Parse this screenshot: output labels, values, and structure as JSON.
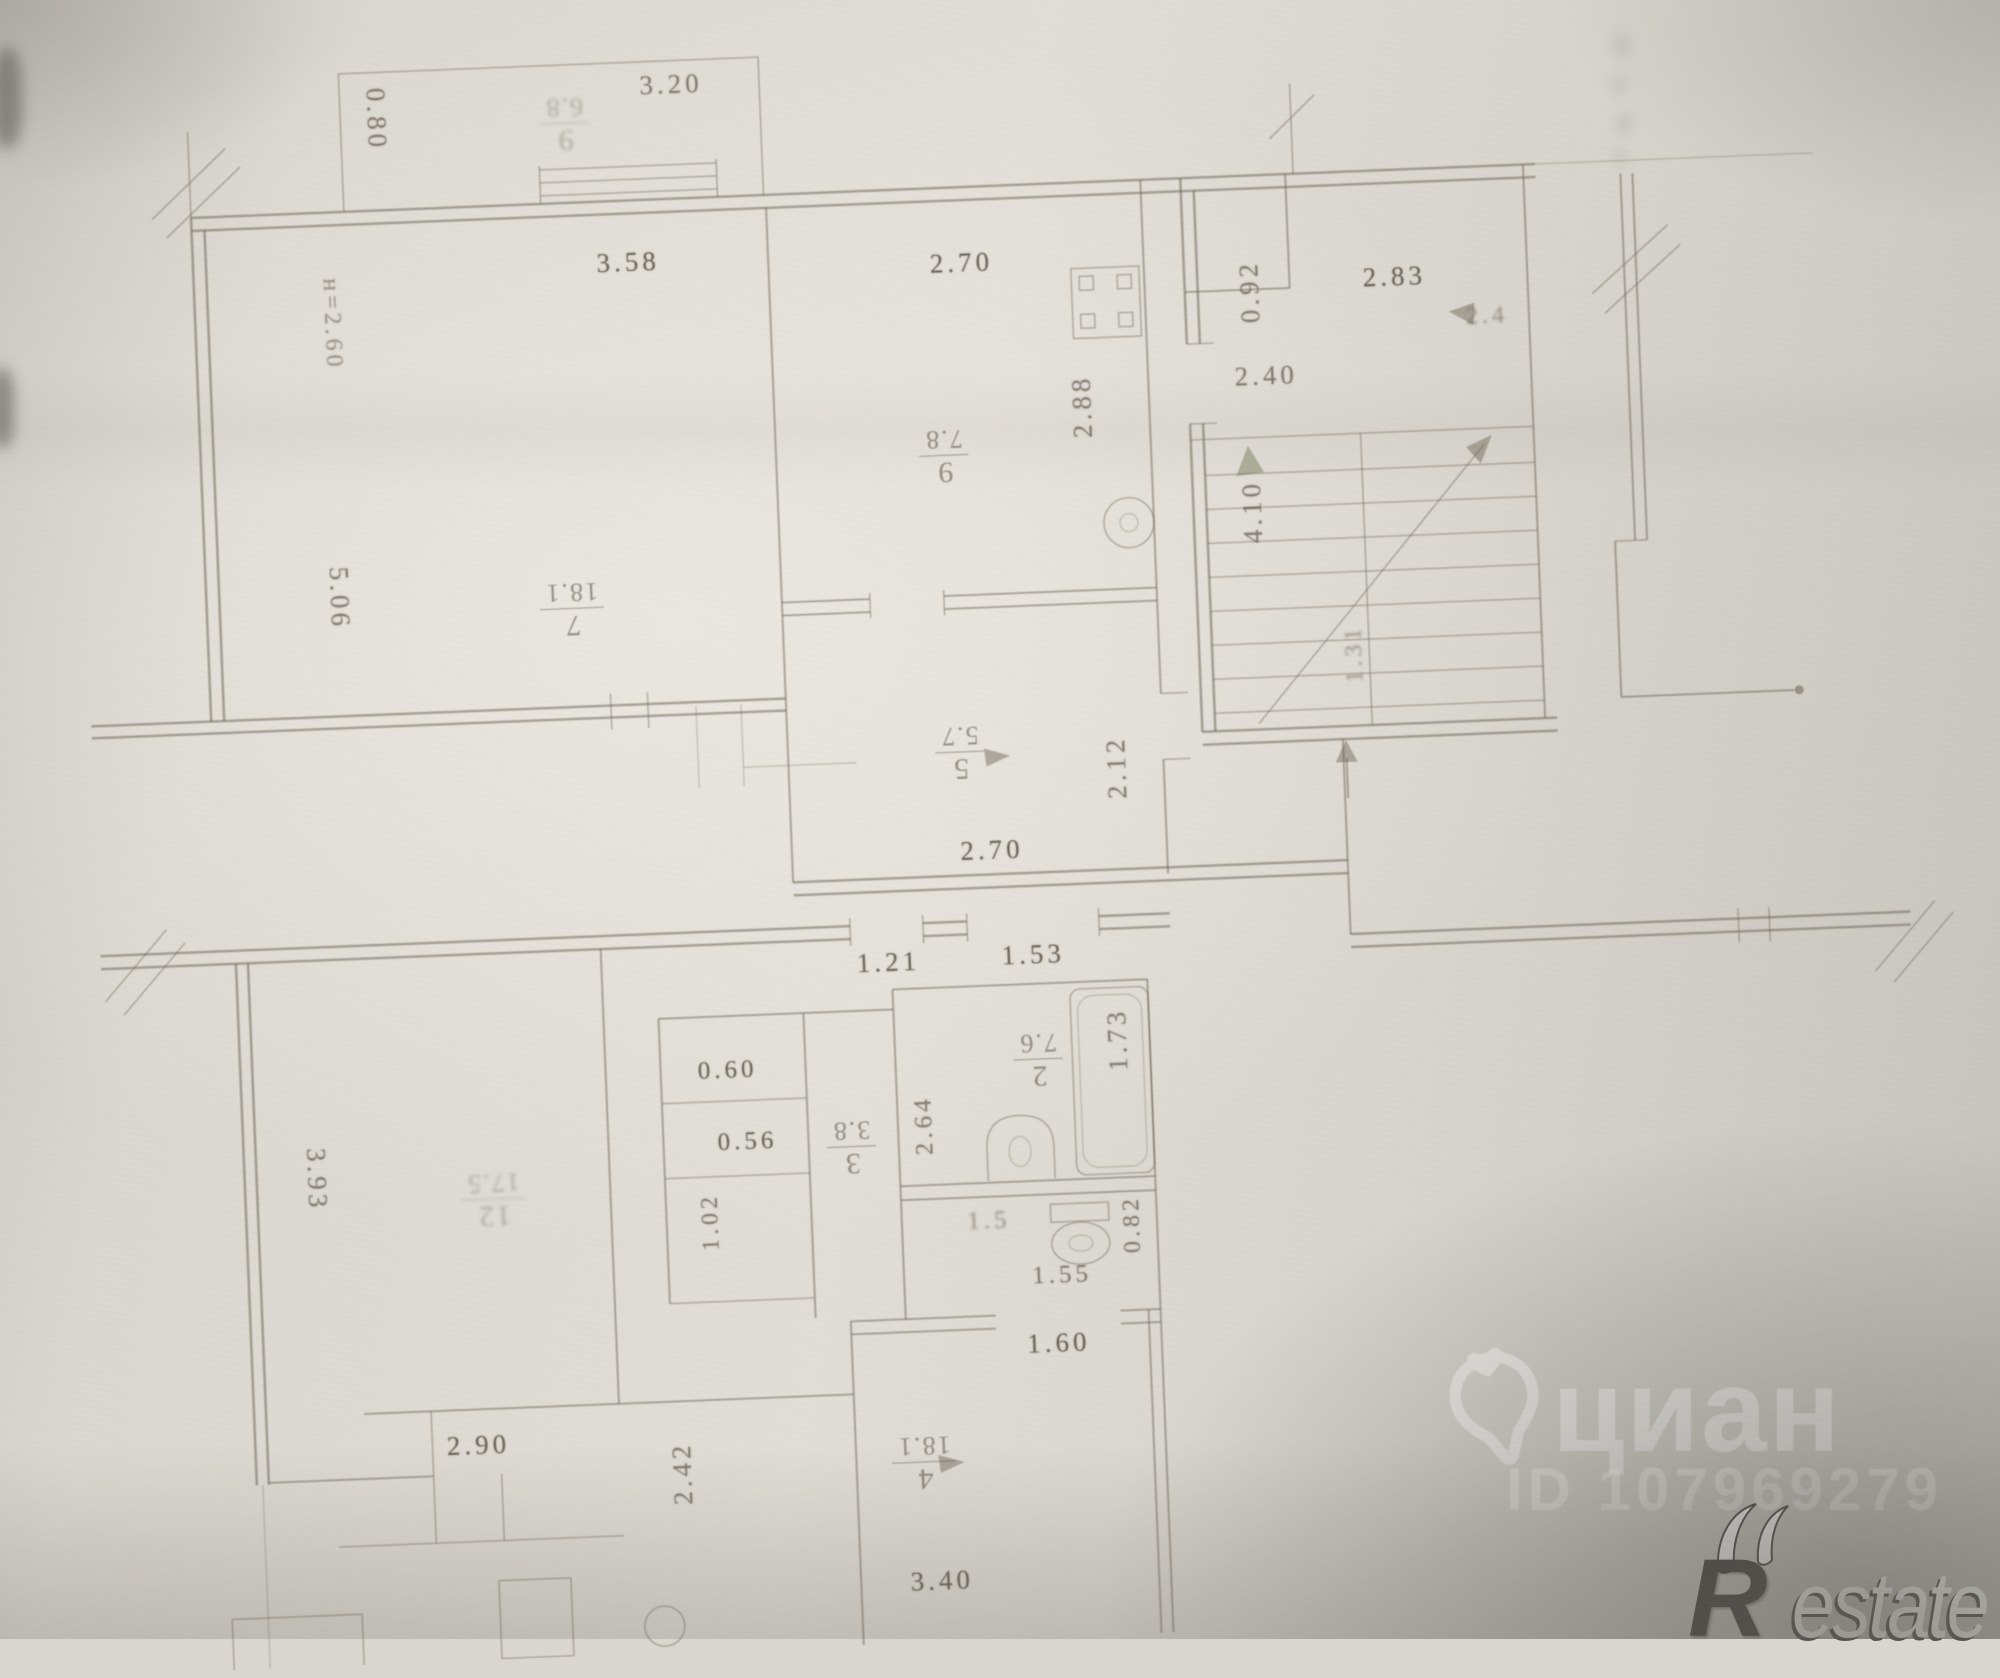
{
  "plan": {
    "dims": {
      "balcony_width": "0.80",
      "balcony_length": "3.20",
      "room7_window": "3.58",
      "ceiling_height": "н=2.60",
      "room7_side": "5.06",
      "kitchen_width": "2.70",
      "kitchen_side": "2.88",
      "vestibule_width": "0.92",
      "landing_width": "2.83",
      "landing_depth": "2.40",
      "entry_door": "2.4",
      "stair_length": "4.10",
      "stair_note": "1.31",
      "hall_side": "2.12",
      "hall_width": "2.70",
      "door_a": "1.21",
      "door_b": "1.53",
      "room12_side": "3.93",
      "closet_a": "0.60",
      "closet_b": "0.56",
      "closet_side": "1.02",
      "room3_side": "2.64",
      "bath_length": "1.73",
      "wc_side": "0.82",
      "wc_note": "1.5",
      "wc_width": "1.55",
      "room4_door": "1.60",
      "room4_side": "2.42",
      "room_bl_width": "2.90",
      "room4_width": "3.40"
    },
    "rooms": {
      "balcony": {
        "number": "9",
        "area": "6.8"
      },
      "room7": {
        "number": "7",
        "area": "18.1"
      },
      "kitchen": {
        "number": "9",
        "area": "7.8"
      },
      "hall": {
        "number": "5",
        "area": "5.7"
      },
      "room12": {
        "number": "12",
        "area": "17.5"
      },
      "room3": {
        "number": "3",
        "area": "3.8"
      },
      "room2": {
        "number": "2",
        "area": "7.6"
      },
      "room4": {
        "number": "4",
        "area": "18.1"
      }
    }
  },
  "watermarks": {
    "cian": {
      "brand": "циан",
      "listing_id": "ID 107969279"
    },
    "restate": {
      "initial": "R",
      "rest": "estate"
    }
  },
  "colors": {
    "paper": "#d9d6cf",
    "ink": "#696250",
    "watermark_white": "#ffffff",
    "restate_dark": "#43403c"
  }
}
